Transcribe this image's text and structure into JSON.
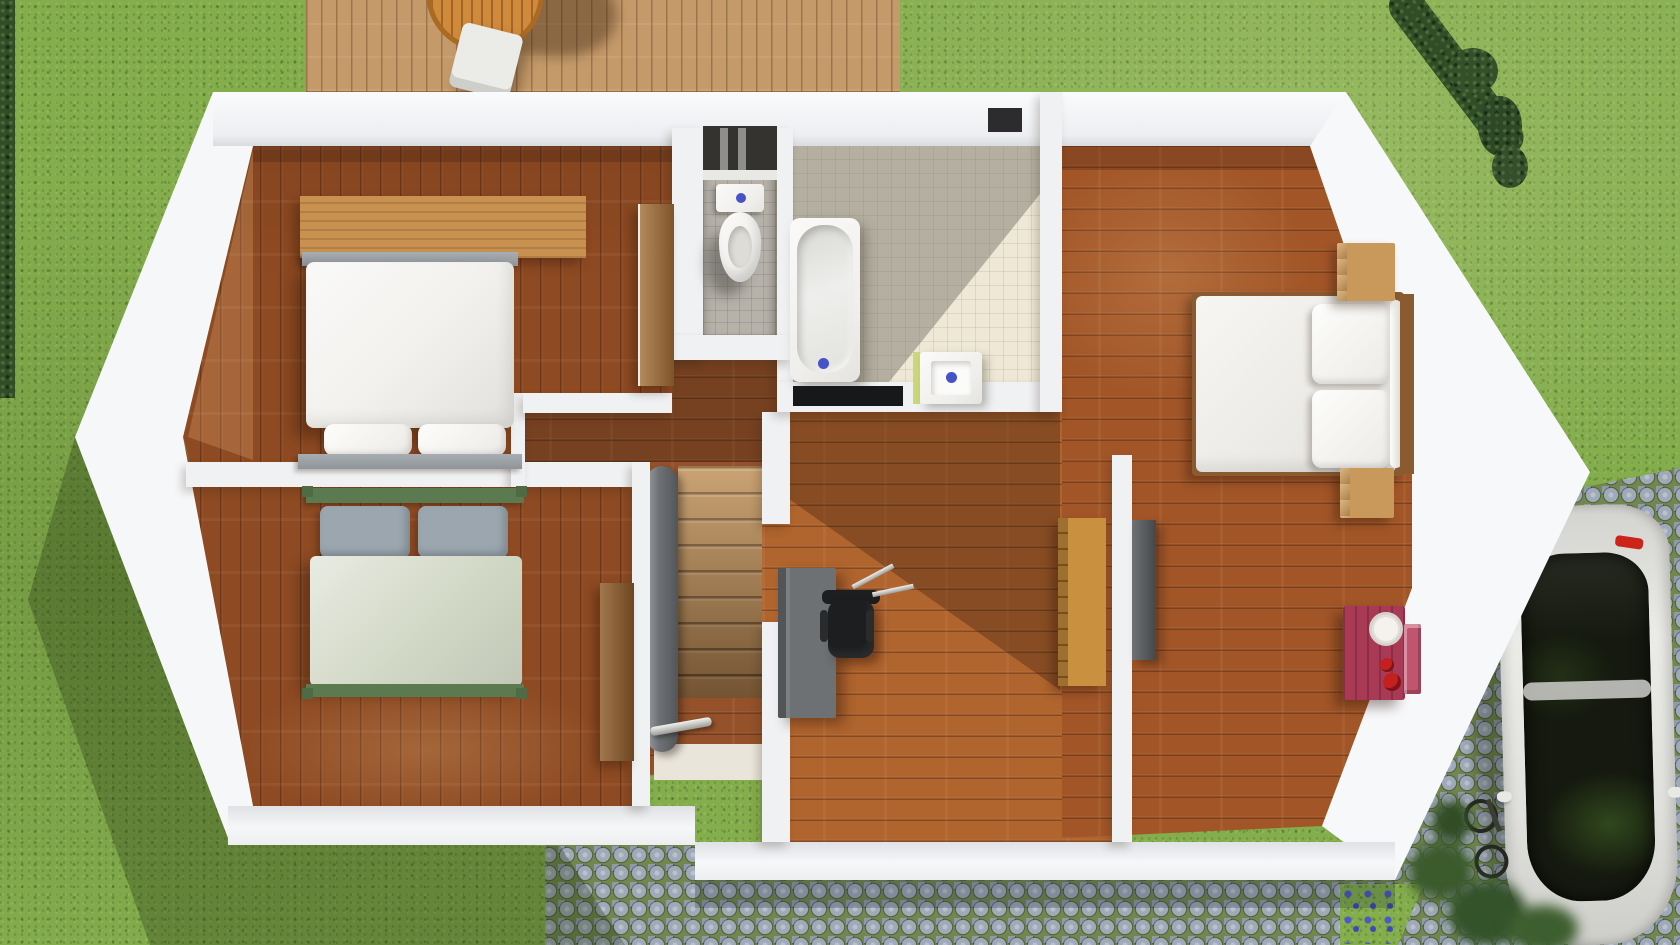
{
  "scene": {
    "name": "3d-floor-plan-top-view",
    "view": "top-down 3D render",
    "description": "Upper floor of a house seen from above: three bedrooms, bathroom, WC, staircase hall and office nook, surrounded by lawn, wooden deck, cobblestone driveway with parked white car"
  },
  "colors": {
    "grass": "#84ad4c",
    "hedge": "#2f4d26",
    "deck_wood": "#c59a6a",
    "cobble_grout": "#72874e",
    "floor_dark": "#8e4a22",
    "floor_mid": "#a25628",
    "floor_light": "#b0642e",
    "hall_wood": "#95522a",
    "tile_bath": "#efe8d6",
    "tile_wc": "#b6b2aa",
    "wall_white": "#f0f1f3",
    "drain_blue": "#4653c8",
    "mat_black": "#17181a",
    "desk_gray": "#6d7174",
    "chair_black": "#1d1e20",
    "shelf_orange": "#c8903f",
    "door_wood": "#9a6a38",
    "door_gray": "#56595c",
    "banister_gray": "#6e7276",
    "stair_wood": "#b98c58",
    "landing": "#e9e5da",
    "bed1_duvet": "#f2f1ee",
    "bed_frame_gray": "#9aa0a6",
    "bed2_duvet": "#d2d8c6",
    "bed2_pillow": "#9ba6af",
    "bed2_frame": "#5c7a50",
    "rug_wood": "#c8914f",
    "wardrobe_wood": "#8a5c30",
    "nightstand_wood": "#c8995a",
    "headboard_wood": "#8a5a30",
    "dresser_red": "#a83a56",
    "toy_red": "#c42020",
    "clock_face": "#f5f2ee",
    "towel_green": "#ccd878",
    "car_body": "#e4e4e0",
    "car_glass": "#15190f",
    "car_taillight": "#cc2418",
    "table_orange": "#cf8a3c"
  },
  "exterior": {
    "lawn": "grass lawn",
    "deck": {
      "name": "wooden deck",
      "furniture": [
        "round patio table",
        "white patio chair"
      ]
    },
    "driveway": {
      "name": "cobblestone driveway and path",
      "items": [
        "white car",
        "bicycle",
        "shrubs",
        "blue flowers"
      ]
    },
    "hedges": [
      "left edge hedge",
      "north-east hedge row"
    ]
  },
  "house": {
    "shape": "elongated hexagon with pointed west and east ends",
    "walls": "white",
    "rooms": [
      {
        "id": "bedroom-1",
        "name": "bedroom top-left",
        "furniture": [
          "double bed white",
          "wood rug",
          "open wooden door"
        ]
      },
      {
        "id": "bedroom-2",
        "name": "bedroom bottom-left",
        "furniture": [
          "double bed green frame",
          "wardrobe panel"
        ]
      },
      {
        "id": "hallway",
        "name": "hall and staircase",
        "furniture": [
          "staircase",
          "banister",
          "metal handrail",
          "landing"
        ]
      },
      {
        "id": "wc",
        "name": "toilet room",
        "furniture": [
          "toilet with cistern",
          "wall niche"
        ]
      },
      {
        "id": "bathroom",
        "name": "bathroom",
        "furniture": [
          "bathtub",
          "square sink",
          "black mat",
          "green towel"
        ]
      },
      {
        "id": "office",
        "name": "middle room office nook",
        "furniture": [
          "gray desk",
          "black office chair",
          "orange shelving unit"
        ]
      },
      {
        "id": "bedroom-3",
        "name": "bedroom right",
        "furniture": [
          "double bed",
          "nightstand top",
          "nightstand bottom",
          "red dresser with clock",
          "open gray door"
        ]
      }
    ]
  }
}
